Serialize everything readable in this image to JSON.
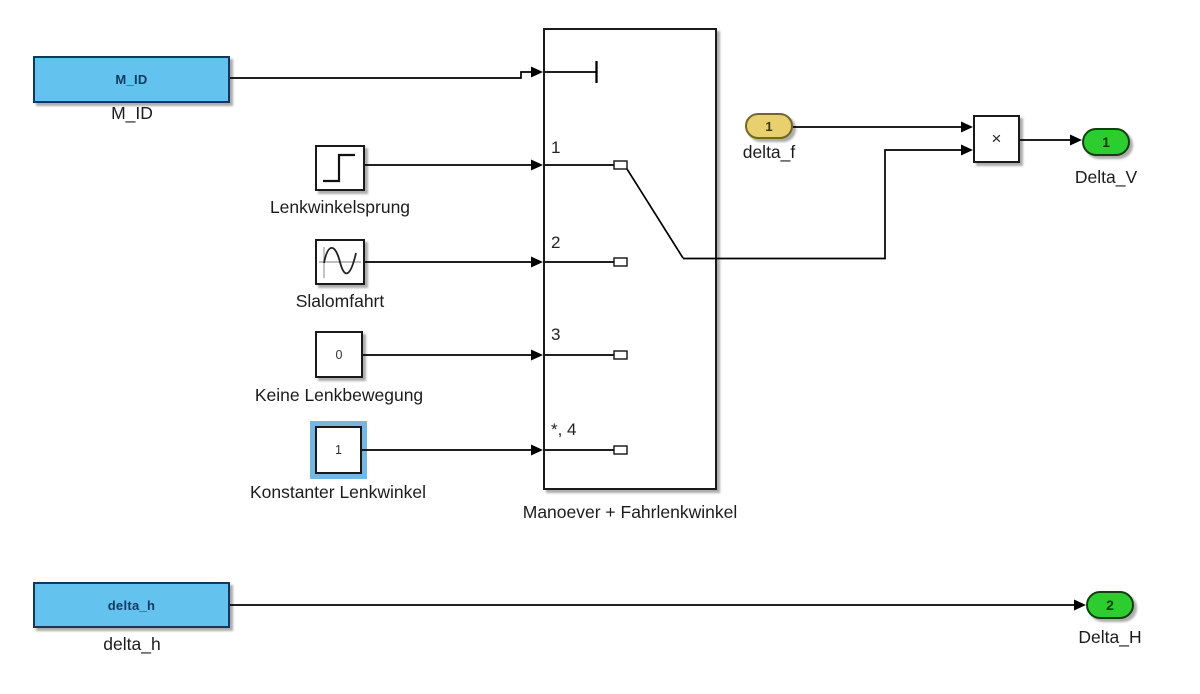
{
  "colors": {
    "canvas_bg": "#ffffff",
    "wire": "#000000",
    "block_blue_fill": "#63c2ee",
    "block_blue_border": "#16365c",
    "block_blue_text": "#123a63",
    "inport_yellow_fill": "#e7d06d",
    "inport_yellow_border": "#756621",
    "inport_yellow_text": "#403509",
    "outport_green_fill": "#2ecd2f",
    "outport_green_border": "#123f12",
    "outport_green_text": "#0b3d0b",
    "selection_highlight": "#74b7e3",
    "block_white_fill": "#ffffff",
    "block_border_dark": "#1a1a1a",
    "label_text": "#1c1c1c"
  },
  "blocks": {
    "m_id": {
      "tag_text": "M_ID",
      "label": "M_ID"
    },
    "lenkwinkelsprung": {
      "label": "Lenkwinkelsprung",
      "icon": "step-signal-icon"
    },
    "slalomfahrt": {
      "label": "Slalomfahrt",
      "icon": "sine-wave-icon"
    },
    "keine_lenkbewegung": {
      "value": "0",
      "label": "Keine Lenkbewegung"
    },
    "konstanter_lenkwinkel": {
      "value": "1",
      "label": "Konstanter Lenkwinkel",
      "selected": true
    },
    "multiport_switch": {
      "label": "Manoever + Fahrlenkwinkel",
      "port_labels": [
        "1",
        "2",
        "3",
        "*, 4"
      ]
    },
    "delta_f_inport": {
      "port_number": "1",
      "label": "delta_f"
    },
    "product": {
      "operator": "×"
    },
    "delta_v_outport": {
      "port_number": "1",
      "label": "Delta_V"
    },
    "delta_h_from": {
      "tag_text": "delta_h",
      "label": "delta_h"
    },
    "delta_h_outport": {
      "port_number": "2",
      "label": "Delta_H"
    }
  }
}
